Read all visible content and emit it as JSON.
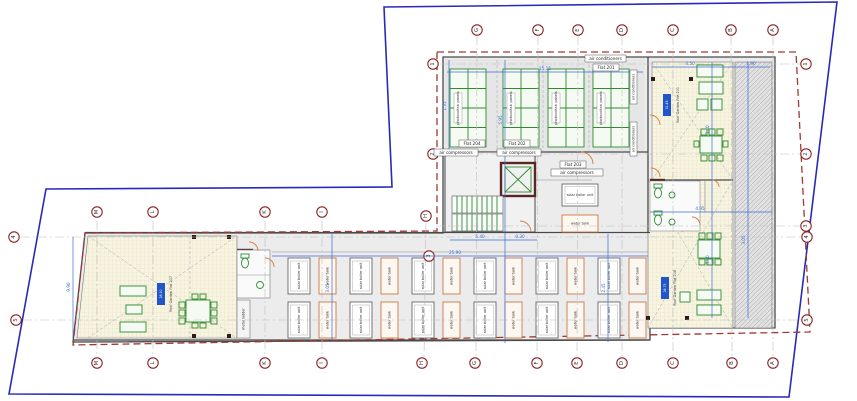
{
  "grid": {
    "columns": [
      "M",
      "L",
      "K",
      "I",
      "H",
      "G",
      "F",
      "E",
      "D",
      "C",
      "B",
      "A"
    ],
    "rows": [
      "1",
      "2",
      "3",
      "4",
      "5"
    ]
  },
  "labels": {
    "flat_201": "Flat 201",
    "flat_202": "Flat 202",
    "flat_203": "Flat 203",
    "flat_204": "Flat 204",
    "air_conditioners": "air conditioners",
    "air_compressors": "air compressors",
    "photovoltaic_panels": "photovoltaic panels",
    "water_tank": "water tank",
    "boiler_unit": "solar boiler unit",
    "roof_garden_tr": "Roof Garden Flat 201",
    "roof_garden_bl": "Roof Garden Flat 207",
    "roof_garden_br": "Roof Garden Flat 208",
    "area_tr": "31.45",
    "area_bl": "28.10",
    "area_br": "26.75",
    "metal_ladder": "metal ladder"
  },
  "dimensions": {
    "d1": "15.15",
    "d2": "4.50",
    "d3": "1.90",
    "d4": "5.40",
    "d5": "0.30",
    "d6": "25.90",
    "d7": "4.95",
    "d8": "5.95",
    "d9": "3.40",
    "d10": "4.40",
    "d11": "3.05",
    "d12": "3.05",
    "d13": "2.45",
    "d14": "9.90",
    "d15": "1.35"
  },
  "colors": {
    "property_boundary_blue": "#2a2ab8",
    "plot_outline_red": "#9e3a32",
    "wall_dark": "#4a4a4a",
    "wall_maroon": "#5a2525",
    "fixture_green": "#2e8b2e",
    "garden_fill": "#f7f4e1",
    "roof_fill": "#ececec",
    "dimension_blue": "#3b6cd4",
    "stamp_blue": "#2255cc",
    "door_orange": "#d4824a"
  }
}
